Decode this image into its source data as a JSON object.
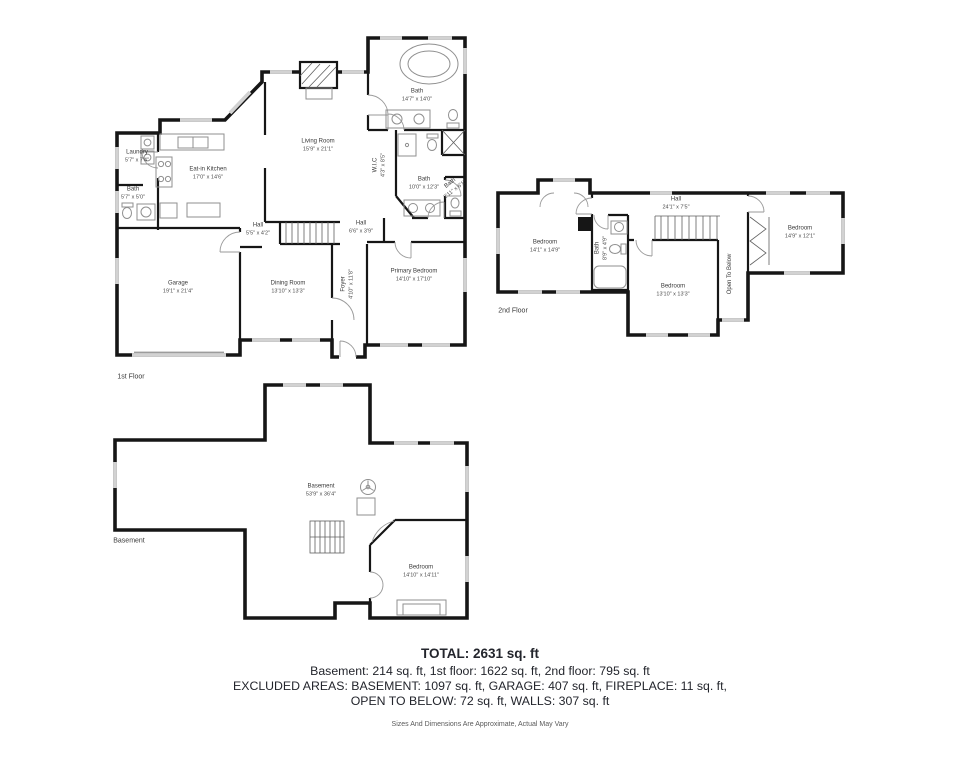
{
  "floors": {
    "first": {
      "label": "1st Floor",
      "rooms": {
        "laundry": {
          "name": "Laundry",
          "dims": "5'7\" x 7'4\""
        },
        "bath_small": {
          "name": "Bath",
          "dims": "5'7\" x 5'0\""
        },
        "kitchen": {
          "name": "Eat-in Kitchen",
          "dims": "17'0\" x 14'6\""
        },
        "living": {
          "name": "Living Room",
          "dims": "15'9\" x 21'1\""
        },
        "bath_top": {
          "name": "Bath",
          "dims": "14'7\" x 14'0\""
        },
        "wic": {
          "name": "W.I.C",
          "dims": "4'3\" x 8'5\""
        },
        "bath_mid": {
          "name": "Bath",
          "dims": "10'0\" x 12'3\""
        },
        "bath_right": {
          "name": "Bath",
          "dims": "2'11\" x 6'1\""
        },
        "hall_small": {
          "name": "Hall",
          "dims": "5'5\" x 4'2\""
        },
        "hall": {
          "name": "Hall",
          "dims": "6'6\" x 3'9\""
        },
        "foyer": {
          "name": "Foyer",
          "dims": "4'10\" x 11'8\""
        },
        "garage": {
          "name": "Garage",
          "dims": "19'1\" x 21'4\""
        },
        "dining": {
          "name": "Dining Room",
          "dims": "13'10\" x 13'3\""
        },
        "primary": {
          "name": "Primary Bedroom",
          "dims": "14'10\" x 17'10\""
        }
      }
    },
    "second": {
      "label": "2nd Floor",
      "rooms": {
        "bedroom_left": {
          "name": "Bedroom",
          "dims": "14'1\" x 14'9\""
        },
        "hall": {
          "name": "Hall",
          "dims": "24'1\" x 7'5\""
        },
        "bath": {
          "name": "Bath",
          "dims": "8'9\" x 4'9\""
        },
        "bedroom_mid": {
          "name": "Bedroom",
          "dims": "13'10\" x 13'3\""
        },
        "bedroom_right": {
          "name": "Bedroom",
          "dims": "14'9\" x 12'1\""
        },
        "open_below": {
          "name": "Open To Below"
        }
      }
    },
    "basement": {
      "label": "Basement",
      "rooms": {
        "basement": {
          "name": "Basement",
          "dims": "53'9\" x 36'4\""
        },
        "bedroom": {
          "name": "Bedroom",
          "dims": "14'10\" x 14'11\""
        }
      }
    }
  },
  "summary": {
    "total": "TOTAL: 2631 sq. ft",
    "line2": "Basement: 214 sq. ft, 1st floor: 1622 sq. ft, 2nd floor: 795 sq. ft",
    "line3": "EXCLUDED AREAS: BASEMENT: 1097 sq. ft, GARAGE: 407 sq. ft, FIREPLACE: 11 sq. ft,",
    "line4": "OPEN TO BELOW: 72 sq. ft, WALLS: 307 sq. ft",
    "disclaimer": "Sizes And Dimensions Are Approximate, Actual May Vary"
  },
  "colors": {
    "wall": "#161616",
    "window": "#d2d2d2",
    "fixture": "#8f8f8f",
    "label_text": "#3a3a3a",
    "summary_text": "#23252c",
    "disclaimer_text": "#5a5a5a",
    "background": "#ffffff"
  }
}
